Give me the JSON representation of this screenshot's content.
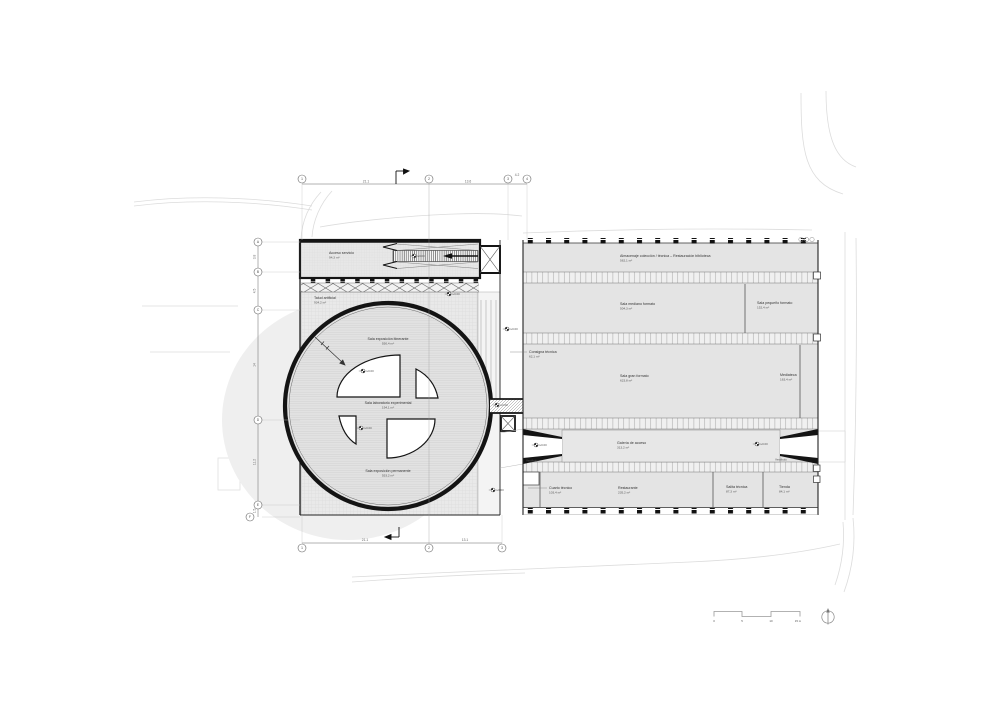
{
  "grid": {
    "top_bubbles": [
      "1",
      "2",
      "3",
      "4"
    ],
    "top_dims": [
      "21.1",
      "13.6",
      "4.2"
    ],
    "bottom_bubbles": [
      "1",
      "2",
      "3"
    ],
    "bottom_dims": [
      "21.1",
      "13.1"
    ],
    "left_bubbles": [
      "A",
      "B",
      "C",
      "D",
      "E",
      "F"
    ],
    "left_dims": [
      "3.8",
      "4.5",
      "14",
      "11.2",
      "1.5"
    ]
  },
  "left_building": {
    "service_room": {
      "name": "Acceso servicio",
      "area": "94,3 m²"
    },
    "plaza": {
      "name": "Talud artificial",
      "area": "934,2 m²"
    },
    "sala_itinerante": {
      "name": "Sala exposición itinerante",
      "area": "550,4 m²"
    },
    "sala_laboratorio": {
      "name": "Sala laboratorio experimental",
      "area": "194,1 m²"
    },
    "sala_permanente": {
      "name": "Sala exposición permanente",
      "area": "553,2 m²"
    }
  },
  "right_building": {
    "rooms": [
      {
        "name": "Almacenaje colección / técnica – Restauración biblioteca",
        "area": "562,1 m²"
      },
      {
        "name": "Sala mediano formato",
        "area": "504,3 m²"
      },
      {
        "name": "Sala pequeño formato",
        "area": "152,4 m²"
      },
      {
        "name": "Sala gran formato",
        "area": "623,8 m²"
      },
      {
        "name": "Mediateca",
        "area": "163,4 m²"
      },
      {
        "name": "Galería de acceso",
        "area": "313,2 m²"
      },
      {
        "name": "Cuarto técnico",
        "area": "103,4 m²"
      },
      {
        "name": "Restaurante",
        "area": "235,2 m²"
      },
      {
        "name": "Salita técnica",
        "area": "87,3 m²"
      },
      {
        "name": "Tienda",
        "area": "84,1 m²"
      }
    ],
    "consigna": {
      "name": "Consigna técnica",
      "area": "62,1 m²"
    },
    "vestibulo_left": "Vestíbulo",
    "vestibulo_right": "Vestíbulo"
  },
  "levels": [
    "+0.00",
    "+0.00",
    "+0.00",
    "+0.00",
    "+0.00",
    "+0.00",
    "+0.00",
    "+0.00",
    "+0.00"
  ],
  "scale_bar": [
    "0",
    "5",
    "10",
    "15 m"
  ]
}
